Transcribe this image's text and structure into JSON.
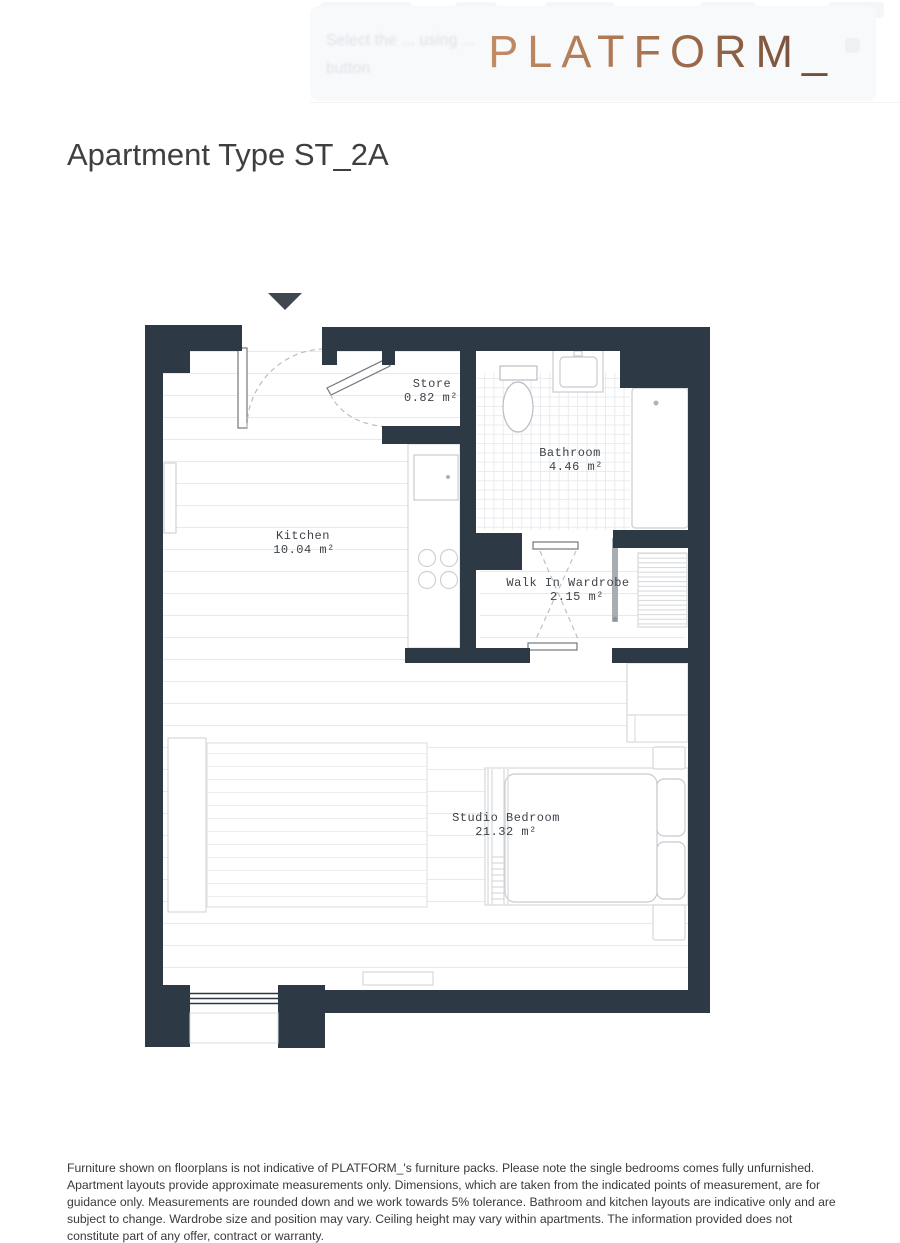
{
  "header": {
    "logo": "PLATFORM_",
    "logo_color_start": "#c38c65",
    "logo_color_end": "#6e4a37",
    "ghost_overlay": {
      "line1": "Select the ... using ...",
      "line2": "button"
    }
  },
  "title": "Apartment Type ST_2A",
  "plan": {
    "wall_color": "#2d3944",
    "entry_arrow_direction": "down",
    "rooms": {
      "store": {
        "name": "Store",
        "area": "0.82 m²"
      },
      "bathroom": {
        "name": "Bathroom",
        "area": "4.46 m²"
      },
      "kitchen": {
        "name": "Kitchen",
        "area": "10.04 m²"
      },
      "wardrobe": {
        "name": "Walk In Wardrobe",
        "area": "2.15 m²"
      },
      "bedroom": {
        "name": "Studio Bedroom",
        "area": "21.32 m²"
      }
    }
  },
  "disclaimer": "Furniture shown on floorplans is not indicative of PLATFORM_'s furniture packs. Please note the single bedrooms comes fully unfurnished. Apartment layouts provide approximate measurements only. Dimensions, which are taken from the indicated points of measurement, are for guidance only. Measurements are rounded down and we work towards 5% tolerance. Bathroom and kitchen layouts are indicative only and are subject to change. Wardrobe size and position may vary. Ceiling height may vary within apartments. The information provided does not constitute part of any offer, contract or warranty."
}
